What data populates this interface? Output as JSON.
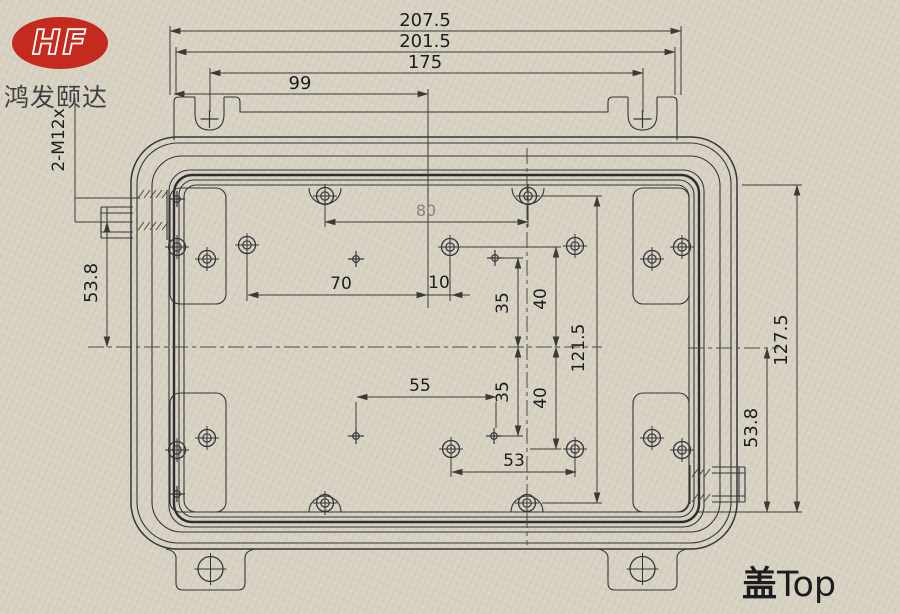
{
  "colors": {
    "paper": "#d8d2c3",
    "line": "#35353a",
    "lineSoft": "#4a463f",
    "logoRed": "#c52a1e",
    "ink": "#1d1d20",
    "faint": "#8a8378"
  },
  "logo": {
    "monogram": "HF",
    "company": "鸿发颐达"
  },
  "caption": {
    "cn": "盖",
    "en": "Top"
  },
  "labels": {
    "thread_spec": "2-M12x"
  },
  "dims": {
    "overall_width": "207.5",
    "flange_width": "201.5",
    "slot_span": "175",
    "d99": "99",
    "d80": "80",
    "d70": "70",
    "d10": "10",
    "d35_upper": "35",
    "d40_upper": "40",
    "d121_5": "121.5",
    "d55": "55",
    "d35_lower": "35",
    "d40_lower": "40",
    "d53": "53",
    "d53_8_left": "53.8",
    "d53_8_right": "53.8",
    "d127_5": "127.5"
  }
}
